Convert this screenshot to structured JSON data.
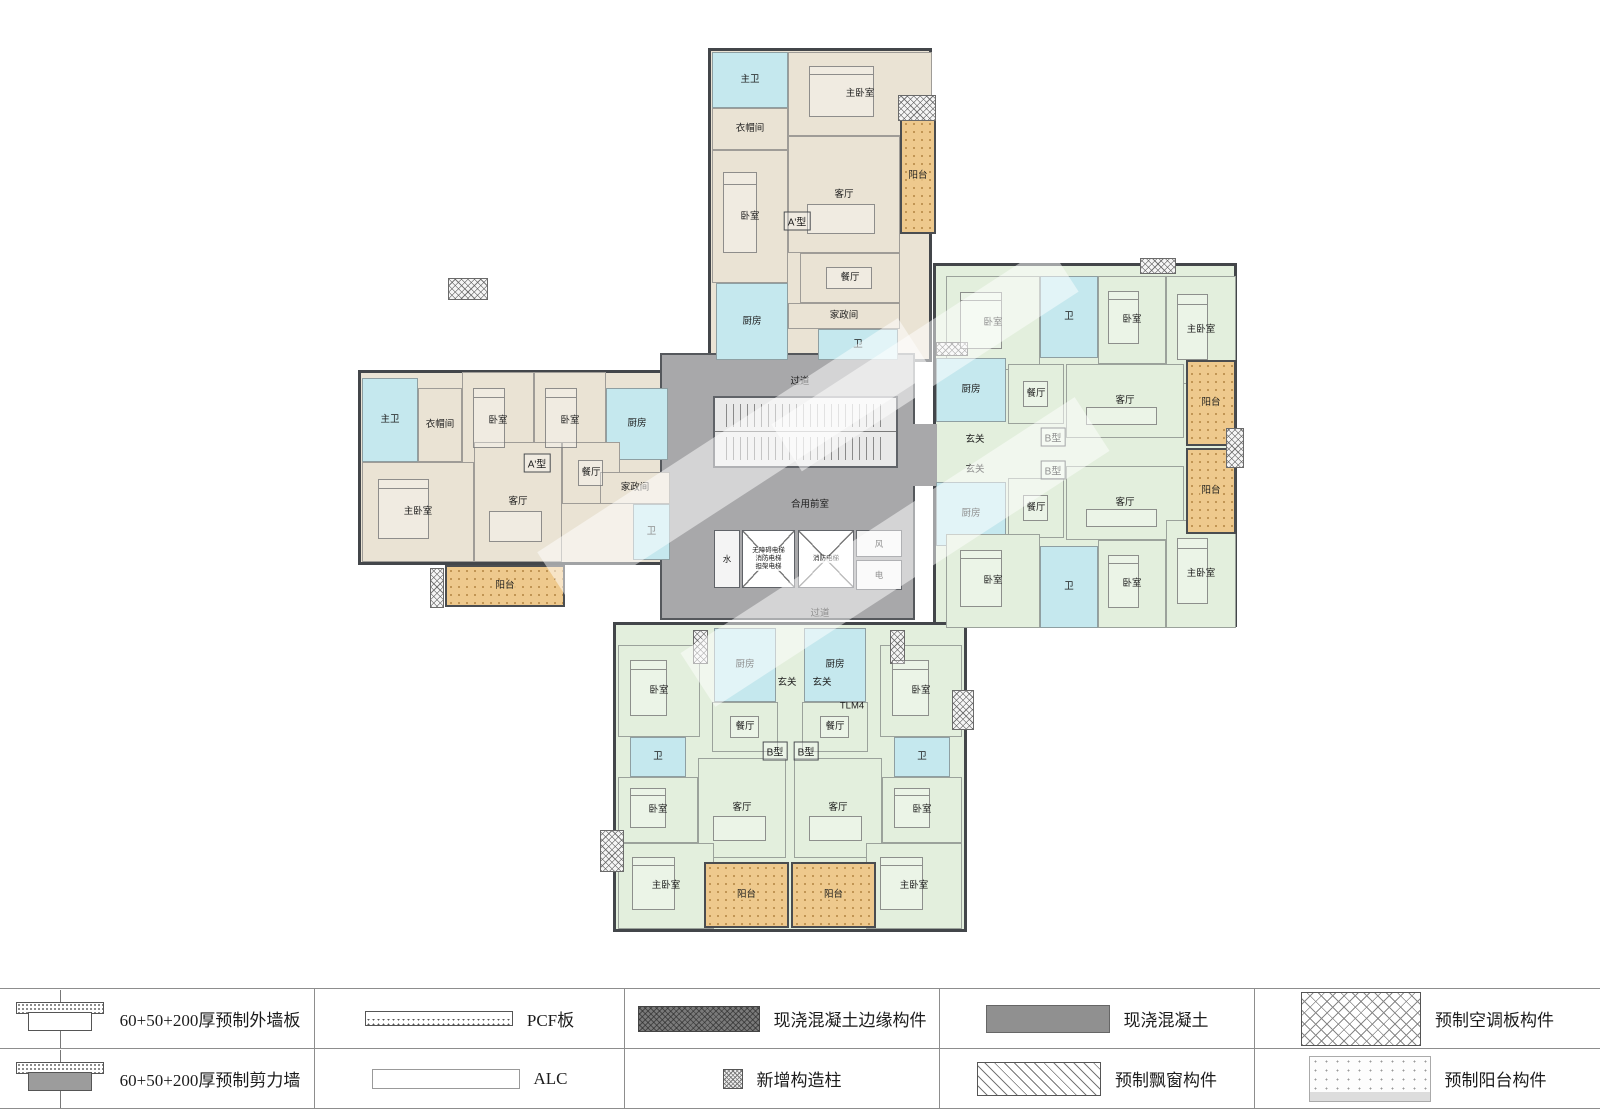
{
  "colors": {
    "unit_a_fill": "#eae3d4",
    "unit_b_fill": "#e3efdd",
    "wet_room_fill": "#c5e8ee",
    "balcony_fill": "#eec98d",
    "core_fill": "#a8a8aa",
    "wall": "#43464a"
  },
  "plan": {
    "units": [
      {
        "id": "top-a",
        "fill": "beige",
        "x": 708,
        "y": 48,
        "w": 224,
        "h": 314
      },
      {
        "id": "left-a",
        "fill": "beige",
        "x": 358,
        "y": 370,
        "w": 314,
        "h": 195
      },
      {
        "id": "right-b",
        "fill": "green",
        "x": 933,
        "y": 263,
        "w": 304,
        "h": 364
      },
      {
        "id": "bottom-b",
        "fill": "green",
        "x": 613,
        "y": 622,
        "w": 354,
        "h": 310
      }
    ],
    "core": {
      "x": 660,
      "y": 353,
      "w": 255,
      "h": 267,
      "connectors": [
        {
          "x": 913,
          "y": 424,
          "w": 24,
          "h": 62
        }
      ],
      "stair": {
        "x": 713,
        "y": 396,
        "w": 185,
        "h": 72
      },
      "shafts": [
        {
          "id": "water",
          "label": "水",
          "x": 714,
          "y": 530,
          "w": 26,
          "h": 58
        },
        {
          "id": "air",
          "label": "风",
          "x": 856,
          "y": 530,
          "w": 46,
          "h": 27
        },
        {
          "id": "power",
          "label": "电",
          "x": 856,
          "y": 560,
          "w": 46,
          "h": 30
        }
      ],
      "elevators": [
        {
          "x": 742,
          "y": 530,
          "w": 53,
          "h": 58,
          "lines": [
            "无障碍电梯",
            "消防电梯",
            "担架电梯"
          ]
        },
        {
          "x": 798,
          "y": 530,
          "w": 56,
          "h": 58,
          "lines": [
            "消防电梯"
          ]
        }
      ]
    },
    "rooms": [
      {
        "l": "主卫",
        "f": "cyan",
        "x": 712,
        "y": 52,
        "w": 76,
        "h": 56
      },
      {
        "l": "衣帽间",
        "f": "beige",
        "x": 712,
        "y": 108,
        "w": 76,
        "h": 42
      },
      {
        "l": "卧室",
        "f": "beige",
        "x": 712,
        "y": 150,
        "w": 76,
        "h": 133,
        "furn": "bed"
      },
      {
        "l": "主卧室",
        "f": "beige",
        "x": 788,
        "y": 52,
        "w": 144,
        "h": 84,
        "furn": "bed"
      },
      {
        "l": "客厅",
        "f": "beige",
        "x": 788,
        "y": 136,
        "w": 112,
        "h": 117,
        "furn": "sofa"
      },
      {
        "l": "餐厅",
        "f": "beige",
        "x": 800,
        "y": 253,
        "w": 100,
        "h": 50,
        "furn": "table"
      },
      {
        "l": "家政间",
        "f": "beige",
        "x": 788,
        "y": 303,
        "w": 112,
        "h": 26
      },
      {
        "l": "卫",
        "f": "cyan",
        "x": 818,
        "y": 329,
        "w": 80,
        "h": 31
      },
      {
        "l": "厨房",
        "f": "cyan",
        "x": 716,
        "y": 283,
        "w": 72,
        "h": 77
      },
      {
        "l": "主卫",
        "f": "cyan",
        "x": 362,
        "y": 378,
        "w": 56,
        "h": 84
      },
      {
        "l": "衣帽间",
        "f": "beige",
        "x": 418,
        "y": 388,
        "w": 44,
        "h": 74
      },
      {
        "l": "卧室",
        "f": "beige",
        "x": 462,
        "y": 372,
        "w": 72,
        "h": 98,
        "furn": "bed"
      },
      {
        "l": "卧室",
        "f": "beige",
        "x": 534,
        "y": 372,
        "w": 72,
        "h": 98,
        "furn": "bed"
      },
      {
        "l": "厨房",
        "f": "cyan",
        "x": 606,
        "y": 388,
        "w": 62,
        "h": 72
      },
      {
        "l": "主卧室",
        "f": "beige",
        "x": 362,
        "y": 462,
        "w": 112,
        "h": 100,
        "furn": "bed"
      },
      {
        "l": "客厅",
        "f": "beige",
        "x": 474,
        "y": 442,
        "w": 88,
        "h": 120,
        "furn": "sofa"
      },
      {
        "l": "餐厅",
        "f": "beige",
        "x": 562,
        "y": 442,
        "w": 58,
        "h": 62,
        "furn": "table"
      },
      {
        "l": "家政间",
        "f": "beige",
        "x": 600,
        "y": 472,
        "w": 70,
        "h": 32
      },
      {
        "l": "卫",
        "f": "cyan",
        "x": 633,
        "y": 504,
        "w": 37,
        "h": 56
      },
      {
        "l": "卧室",
        "f": "green",
        "x": 946,
        "y": 276,
        "w": 94,
        "h": 94,
        "furn": "bed"
      },
      {
        "l": "卫",
        "f": "cyan",
        "x": 1040,
        "y": 276,
        "w": 58,
        "h": 82
      },
      {
        "l": "卧室",
        "f": "green",
        "x": 1098,
        "y": 276,
        "w": 68,
        "h": 88,
        "furn": "bed"
      },
      {
        "l": "主卧室",
        "f": "green",
        "x": 1166,
        "y": 276,
        "w": 70,
        "h": 108,
        "furn": "bed"
      },
      {
        "l": "厨房",
        "f": "cyan",
        "x": 936,
        "y": 358,
        "w": 70,
        "h": 64
      },
      {
        "l": "餐厅",
        "f": "green",
        "x": 1008,
        "y": 364,
        "w": 56,
        "h": 60,
        "furn": "table"
      },
      {
        "l": "客厅",
        "f": "green",
        "x": 1066,
        "y": 364,
        "w": 118,
        "h": 74,
        "furn": "sofa"
      },
      {
        "l": "厨房",
        "f": "cyan",
        "x": 936,
        "y": 482,
        "w": 70,
        "h": 64
      },
      {
        "l": "餐厅",
        "f": "green",
        "x": 1008,
        "y": 478,
        "w": 56,
        "h": 60,
        "furn": "table"
      },
      {
        "l": "客厅",
        "f": "green",
        "x": 1066,
        "y": 466,
        "w": 118,
        "h": 74,
        "furn": "sofa"
      },
      {
        "l": "卧室",
        "f": "green",
        "x": 946,
        "y": 534,
        "w": 94,
        "h": 94,
        "furn": "bed"
      },
      {
        "l": "卫",
        "f": "cyan",
        "x": 1040,
        "y": 546,
        "w": 58,
        "h": 82
      },
      {
        "l": "卧室",
        "f": "green",
        "x": 1098,
        "y": 540,
        "w": 68,
        "h": 88,
        "furn": "bed"
      },
      {
        "l": "主卧室",
        "f": "green",
        "x": 1166,
        "y": 520,
        "w": 70,
        "h": 108,
        "furn": "bed"
      },
      {
        "l": "卧室",
        "f": "green",
        "x": 618,
        "y": 645,
        "w": 82,
        "h": 92,
        "furn": "bed"
      },
      {
        "l": "厨房",
        "f": "cyan",
        "x": 714,
        "y": 628,
        "w": 62,
        "h": 74
      },
      {
        "l": "餐厅",
        "f": "green",
        "x": 712,
        "y": 702,
        "w": 66,
        "h": 50,
        "furn": "table"
      },
      {
        "l": "卫",
        "f": "cyan",
        "x": 630,
        "y": 737,
        "w": 56,
        "h": 40
      },
      {
        "l": "卧室",
        "f": "green",
        "x": 618,
        "y": 777,
        "w": 80,
        "h": 66,
        "furn": "bed"
      },
      {
        "l": "客厅",
        "f": "green",
        "x": 698,
        "y": 758,
        "w": 88,
        "h": 100,
        "furn": "sofa"
      },
      {
        "l": "主卧室",
        "f": "green",
        "x": 618,
        "y": 843,
        "w": 96,
        "h": 86,
        "furn": "bed"
      },
      {
        "l": "卧室",
        "f": "green",
        "x": 880,
        "y": 645,
        "w": 82,
        "h": 92,
        "furn": "bed"
      },
      {
        "l": "厨房",
        "f": "cyan",
        "x": 804,
        "y": 628,
        "w": 62,
        "h": 74
      },
      {
        "l": "餐厅",
        "f": "green",
        "x": 802,
        "y": 702,
        "w": 66,
        "h": 50,
        "furn": "table"
      },
      {
        "l": "卫",
        "f": "cyan",
        "x": 894,
        "y": 737,
        "w": 56,
        "h": 40
      },
      {
        "l": "卧室",
        "f": "green",
        "x": 882,
        "y": 777,
        "w": 80,
        "h": 66,
        "furn": "bed"
      },
      {
        "l": "客厅",
        "f": "green",
        "x": 794,
        "y": 758,
        "w": 88,
        "h": 100,
        "furn": "sofa"
      },
      {
        "l": "主卧室",
        "f": "green",
        "x": 866,
        "y": 843,
        "w": 96,
        "h": 86,
        "furn": "bed"
      }
    ],
    "balconies": [
      {
        "l": "阳台",
        "x": 900,
        "y": 118,
        "w": 36,
        "h": 116
      },
      {
        "l": "阳台",
        "x": 445,
        "y": 565,
        "w": 120,
        "h": 42
      },
      {
        "l": "阳台",
        "x": 1186,
        "y": 360,
        "w": 50,
        "h": 86
      },
      {
        "l": "阳台",
        "x": 1186,
        "y": 448,
        "w": 50,
        "h": 86
      },
      {
        "l": "阳台",
        "x": 704,
        "y": 862,
        "w": 85,
        "h": 66
      },
      {
        "l": "阳台",
        "x": 791,
        "y": 862,
        "w": 85,
        "h": 66
      }
    ],
    "ac_panels": [
      {
        "x": 898,
        "y": 95,
        "w": 38,
        "h": 26
      },
      {
        "x": 448,
        "y": 278,
        "w": 40,
        "h": 22
      },
      {
        "x": 430,
        "y": 568,
        "w": 14,
        "h": 40
      },
      {
        "x": 1140,
        "y": 258,
        "w": 36,
        "h": 16
      },
      {
        "x": 936,
        "y": 342,
        "w": 32,
        "h": 14
      },
      {
        "x": 1226,
        "y": 428,
        "w": 18,
        "h": 40
      },
      {
        "x": 600,
        "y": 830,
        "w": 24,
        "h": 42
      },
      {
        "x": 693,
        "y": 630,
        "w": 15,
        "h": 34
      },
      {
        "x": 890,
        "y": 630,
        "w": 15,
        "h": 34
      },
      {
        "x": 952,
        "y": 690,
        "w": 22,
        "h": 40
      }
    ],
    "labels": [
      {
        "t": "过道",
        "x": 800,
        "y": 380
      },
      {
        "t": "合用前室",
        "x": 810,
        "y": 503
      },
      {
        "t": "过道",
        "x": 820,
        "y": 612
      },
      {
        "t": "玄关",
        "x": 975,
        "y": 438
      },
      {
        "t": "玄关",
        "x": 975,
        "y": 468
      },
      {
        "t": "玄关",
        "x": 787,
        "y": 681
      },
      {
        "t": "玄关",
        "x": 822,
        "y": 681
      },
      {
        "t": "A'型",
        "x": 797,
        "y": 221,
        "box": true
      },
      {
        "t": "A'型",
        "x": 537,
        "y": 463,
        "box": true
      },
      {
        "t": "B型",
        "x": 1053,
        "y": 437,
        "box": true
      },
      {
        "t": "B型",
        "x": 1053,
        "y": 470,
        "box": true
      },
      {
        "t": "B型",
        "x": 775,
        "y": 751,
        "box": true
      },
      {
        "t": "B型",
        "x": 806,
        "y": 751,
        "box": true
      },
      {
        "t": "TLM4",
        "x": 852,
        "y": 706
      }
    ],
    "watermarks": [
      {
        "x": 520,
        "y": 430,
        "w": 430,
        "h": 64,
        "rot": -33
      },
      {
        "x": 660,
        "y": 520,
        "w": 470,
        "h": 64,
        "rot": -33
      },
      {
        "x": 760,
        "y": 330,
        "w": 330,
        "h": 56,
        "rot": -33
      }
    ]
  },
  "legend": {
    "items": [
      {
        "label": "60+50+200厚预制外墙板"
      },
      {
        "label": "PCF板"
      },
      {
        "label": "现浇混凝土边缘构件"
      },
      {
        "label": "现浇混凝土"
      },
      {
        "label": "预制空调板构件"
      },
      {
        "label": "60+50+200厚预制剪力墙"
      },
      {
        "label": "ALC"
      },
      {
        "label": "新增构造柱"
      },
      {
        "label": "预制飘窗构件"
      },
      {
        "label": "预制阳台构件"
      }
    ]
  }
}
